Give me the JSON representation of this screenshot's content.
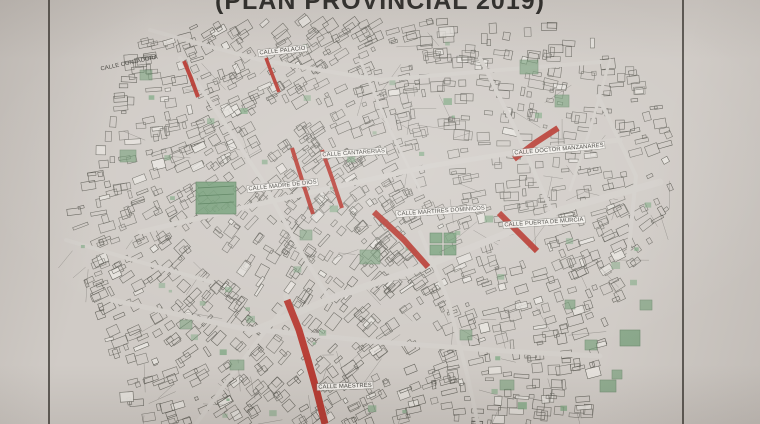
{
  "title": "(PLAN PROVINCIAL 2019)",
  "map": {
    "type": "street-map",
    "highlight_color": "#b5342b",
    "line_color": "#5d5c55",
    "green_color": "#6f9c74",
    "paper_color": "#d3cfca",
    "street_labels": [
      {
        "id": "calle-contadora",
        "text": "CALLE CONTADORA",
        "x": 100,
        "y": 66,
        "rot": -12,
        "boxed": false
      },
      {
        "id": "calle-palacio",
        "text": "CALLE PALACIO",
        "x": 258,
        "y": 50,
        "rot": -6,
        "boxed": true
      },
      {
        "id": "calle-cantarerias",
        "text": "CALLE CANTARERIAS",
        "x": 321,
        "y": 152,
        "rot": -4,
        "boxed": true
      },
      {
        "id": "calle-madre-de-dios",
        "text": "CALLE MADRE DE DIOS",
        "x": 247,
        "y": 186,
        "rot": -6,
        "boxed": true
      },
      {
        "id": "calle-doctor-manzanares",
        "text": "CALLE DOCTOR MANZANARES",
        "x": 513,
        "y": 150,
        "rot": -5,
        "boxed": true
      },
      {
        "id": "calle-martires-dominicos",
        "text": "CALLE MARTIRES DOMINICOS",
        "x": 396,
        "y": 211,
        "rot": -4,
        "boxed": true
      },
      {
        "id": "calle-puerta-de-murcia",
        "text": "CALLE PUERTA DE MURCIA",
        "x": 503,
        "y": 222,
        "rot": -4,
        "boxed": true
      },
      {
        "id": "calle-maestres",
        "text": "CALLE MAESTRES",
        "x": 317,
        "y": 384,
        "rot": -2,
        "boxed": true
      }
    ],
    "highlighted_streets": [
      {
        "id": "calle-contadora",
        "points": [
          [
            184,
            61
          ],
          [
            191,
            78
          ],
          [
            198,
            97
          ]
        ],
        "width": 4
      },
      {
        "id": "calle-palacio",
        "points": [
          [
            266,
            58
          ],
          [
            272,
            74
          ],
          [
            279,
            92
          ]
        ],
        "width": 3.5
      },
      {
        "id": "calle-cantarerias-west",
        "points": [
          [
            292,
            148
          ],
          [
            302,
            180
          ],
          [
            313,
            214
          ]
        ],
        "width": 4
      },
      {
        "id": "calle-cantarerias-east",
        "points": [
          [
            322,
            150
          ],
          [
            332,
            178
          ],
          [
            342,
            208
          ]
        ],
        "width": 4
      },
      {
        "id": "calle-doctor-manzanares",
        "points": [
          [
            558,
            128
          ],
          [
            535,
            143
          ],
          [
            514,
            159
          ]
        ],
        "width": 6
      },
      {
        "id": "calle-martires-dominicos",
        "points": [
          [
            374,
            212
          ],
          [
            404,
            240
          ],
          [
            428,
            267
          ]
        ],
        "width": 6
      },
      {
        "id": "calle-puerta-de-murcia",
        "points": [
          [
            499,
            213
          ],
          [
            517,
            231
          ],
          [
            537,
            251
          ]
        ],
        "width": 6
      },
      {
        "id": "calle-maestres",
        "points": [
          [
            287,
            300
          ],
          [
            299,
            330
          ],
          [
            308,
            360
          ],
          [
            317,
            392
          ],
          [
            325,
            424
          ]
        ],
        "width": 7
      }
    ]
  }
}
